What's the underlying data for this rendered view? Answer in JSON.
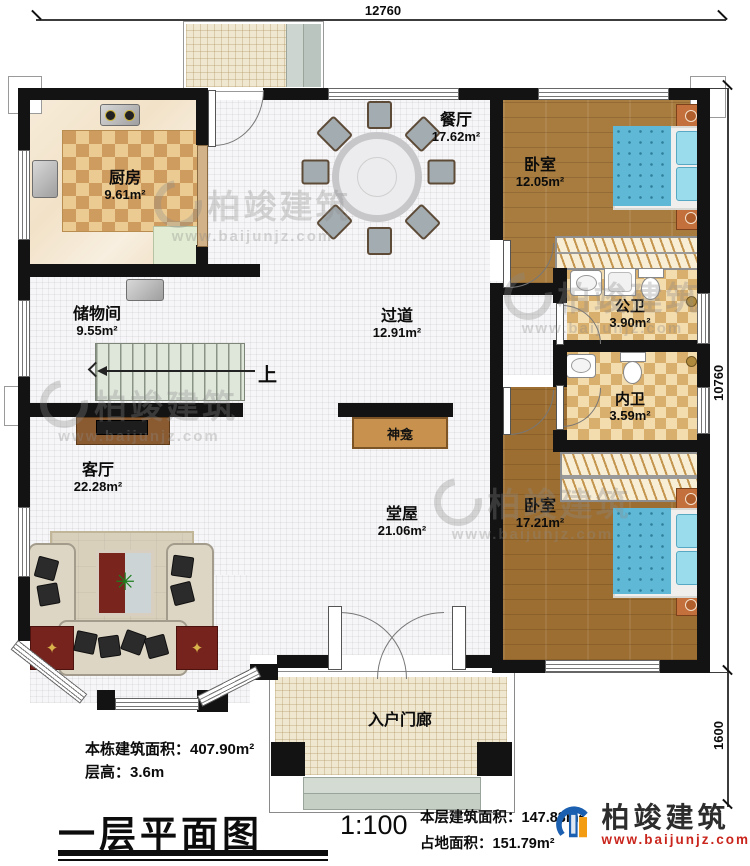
{
  "dimensions": {
    "top": "12760",
    "right": "10760",
    "porch": "1600"
  },
  "rooms": {
    "kitchen": {
      "name": "厨房",
      "area": "9.61m²"
    },
    "dining": {
      "name": "餐厅",
      "area": "17.62m²"
    },
    "bedroom1": {
      "name": "卧室",
      "area": "12.05m²"
    },
    "storage": {
      "name": "储物间",
      "area": "9.55m²"
    },
    "corridor": {
      "name": "过道",
      "area": "12.91m²"
    },
    "public_bath": {
      "name": "公卫",
      "area": "3.90m²"
    },
    "inner_bath": {
      "name": "内卫",
      "area": "3.59m²"
    },
    "living": {
      "name": "客厅",
      "area": "22.28m²"
    },
    "hall": {
      "name": "堂屋",
      "area": "21.06m²"
    },
    "bedroom2": {
      "name": "卧室",
      "area": "17.21m²"
    },
    "entry_porch": {
      "name": "入户门廊"
    }
  },
  "annotations": {
    "stairs_up": "上",
    "shrine": "神龛"
  },
  "footer": {
    "building_area": "本栋建筑面积：407.90m²",
    "floor_height": "层高：3.6m",
    "title": "一层平面图",
    "scale": "1:100",
    "floor_area": "本层建筑面积：147.83m²",
    "footprint": "占地面积：151.79m²"
  },
  "brand": {
    "name": "柏竣建筑",
    "site": "www.baijunjz.com"
  },
  "watermark": {
    "text": "柏竣建筑",
    "site": "www.baijunjz.com"
  },
  "colors": {
    "wall": "#131313",
    "wood": "#a87c3f",
    "bath_tile": "#d9af6d",
    "bed_blue": "#5fb9d6",
    "brand_blue": "#1a5fb0",
    "brand_orange": "#f39c12",
    "brand_red": "#c9251c"
  }
}
